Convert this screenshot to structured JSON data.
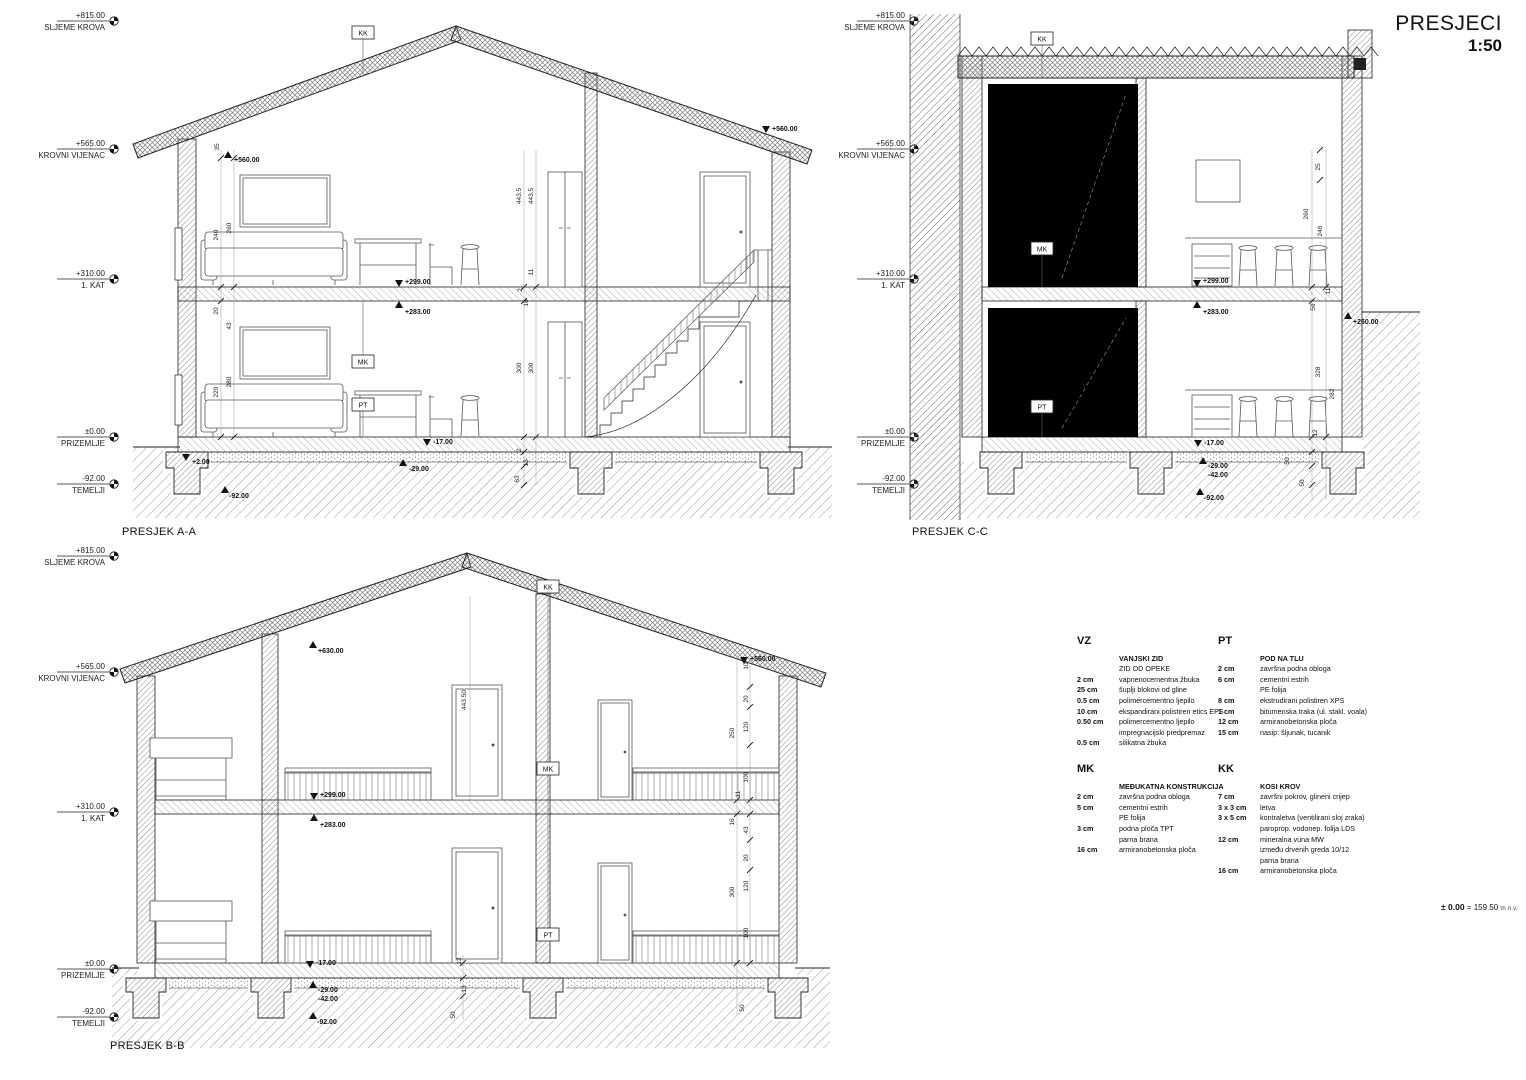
{
  "title": {
    "name": "PRESJECI",
    "scale": "1:50"
  },
  "datum_note": {
    "bold": "± 0.00",
    "rest": "= 159.50",
    "unit": "m n.v."
  },
  "level_labels": [
    {
      "value": "+815.00",
      "name": "SLJEME KROVA"
    },
    {
      "value": "+565.00",
      "name": "KROVNI VIJENAC"
    },
    {
      "value": "+310.00",
      "name": "1. KAT"
    },
    {
      "value": "±0.00",
      "name": "PRIZEMLJE"
    },
    {
      "value": "-92.00",
      "name": "TEMELJI"
    }
  ],
  "sections": {
    "aa": {
      "label": "PRESJEK A-A",
      "boxes": {
        "kk": "KK",
        "mk": "MK",
        "pt": "PT"
      },
      "markers": {
        "m560l": "+560.00",
        "m560r": "+560.00",
        "m299": "+299.00",
        "m283": "+283.00",
        "m17": "-17.00",
        "m2": "+2.00",
        "m29": "-29.00",
        "m92": "-92.00"
      },
      "dims": [
        "35",
        "240",
        "260",
        "20",
        "43",
        "220",
        "280",
        "443.5",
        "443.5",
        "11",
        "2",
        "16",
        "300",
        "300",
        "2",
        "13",
        "63"
      ]
    },
    "bb": {
      "label": "PRESJEK B-B",
      "boxes": {
        "kk": "KK",
        "mk": "MK",
        "pt": "PT"
      },
      "markers": {
        "m630": "+630.00",
        "m560": "+560.00",
        "m299": "+299.00",
        "m283": "+283.00",
        "m17": "-17.00",
        "m29": "-29.00",
        "m42": "-42.00",
        "m92": "-92.00"
      },
      "dims": [
        "443.50",
        "250",
        "300",
        "10",
        "20",
        "120",
        "100",
        "11",
        "16",
        "43",
        "20",
        "120",
        "100",
        "12",
        "13",
        "50",
        "50"
      ]
    },
    "cc": {
      "label": "PRESJEK C-C",
      "boxes": {
        "kk": "KK",
        "mk": "MK",
        "pt": "PT"
      },
      "markers": {
        "m299": "+299.00",
        "m283": "+283.00",
        "m260": "+260.00",
        "m17": "-17.00",
        "m29": "-29.00",
        "m42": "-42.00",
        "m92": "-92.00"
      },
      "dims": [
        "25",
        "260",
        "246",
        "11",
        "59",
        "328",
        "282",
        "12",
        "50",
        "50"
      ]
    }
  },
  "legend": {
    "vz": {
      "code": "VZ",
      "title": "VANJSKI ZID",
      "subtitle": "ZID OD OPEKE",
      "rows": [
        {
          "size": "2 cm",
          "text": "vapnenocementna žbuka"
        },
        {
          "size": "25 cm",
          "text": "šuplji blokovi od gline"
        },
        {
          "size": "0.5 cm",
          "text": "polimercementno ljepilo"
        },
        {
          "size": "10 cm",
          "text": "ekspandirani polistiren etics EPS"
        },
        {
          "size": "0.50 cm",
          "text": "polimercementno ljepilo"
        },
        {
          "size": "",
          "text": "impregnacijski predpremaz"
        },
        {
          "size": "0.5 cm",
          "text": "silikatna žbuka"
        }
      ]
    },
    "pt": {
      "code": "PT",
      "title": "POD NA TLU",
      "rows": [
        {
          "size": "2 cm",
          "text": "završna podna obloga"
        },
        {
          "size": "6 cm",
          "text": "cementni estrih"
        },
        {
          "size": "",
          "text": "PE folija"
        },
        {
          "size": "8 cm",
          "text": "ekstrudirani polistiren XPS"
        },
        {
          "size": "1 cm",
          "text": "bitumenska traka (ul. stakl. voala)"
        },
        {
          "size": "12 cm",
          "text": "armiranobetonska ploča"
        },
        {
          "size": "15 cm",
          "text": "nasip: šljunak, tucanik"
        }
      ]
    },
    "mk": {
      "code": "MK",
      "title": "MEĐUKATNA KONSTRUKCIJA",
      "rows": [
        {
          "size": "2 cm",
          "text": "završna podna obloga"
        },
        {
          "size": "5 cm",
          "text": "cementni estrih"
        },
        {
          "size": "",
          "text": "PE folija"
        },
        {
          "size": "3 cm",
          "text": "podna ploča TPT"
        },
        {
          "size": "",
          "text": "parna brana"
        },
        {
          "size": "16 cm",
          "text": "armiranobetonska ploča"
        }
      ]
    },
    "kk": {
      "code": "KK",
      "title": "KOSI KROV",
      "rows": [
        {
          "size": "7 cm",
          "text": "završni pokrov, glineni crijep"
        },
        {
          "size": "3 x 3 cm",
          "text": "letva"
        },
        {
          "size": "3 x 5 cm",
          "text": "kontraletva (ventilirani sloj zraka)"
        },
        {
          "size": "",
          "text": "paroprop. vodonep. folija LDS"
        },
        {
          "size": "12 cm",
          "text": "mineralna vuna MW"
        },
        {
          "size": "",
          "text": "između drvenih greda 10/12"
        },
        {
          "size": "",
          "text": "parna brana"
        },
        {
          "size": "16 cm",
          "text": "armiranobetonska ploča"
        }
      ]
    }
  }
}
